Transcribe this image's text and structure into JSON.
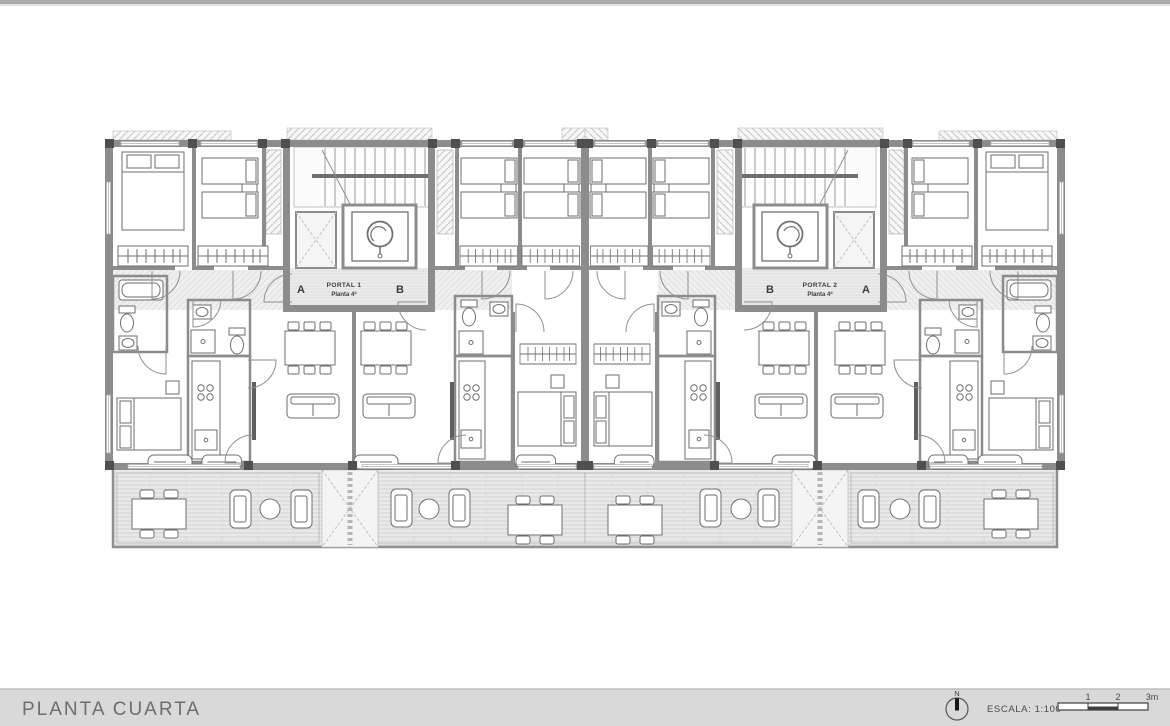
{
  "plan": {
    "portal_1": {
      "name": "PORTAL 1",
      "floor": "Planta 4ª",
      "left_apartment": "A",
      "right_apartment": "B"
    },
    "portal_2": {
      "name": "PORTAL 2",
      "floor": "Planta 4ª",
      "left_apartment": "B",
      "right_apartment": "A"
    }
  },
  "footer": {
    "title": "PLANTA CUARTA",
    "north_label": "N",
    "scale_label": "ESCALA:  1:100",
    "scale_ticks": [
      "1",
      "2",
      "3m"
    ]
  },
  "colors": {
    "wall": "#8c8c8c",
    "pillar": "#4f4f4f",
    "furniture_line": "#6e6e6e",
    "terrace_fill": "#e9e9e9",
    "footer_bar": "#d9d9d9",
    "title_text": "#6e6e6e"
  }
}
